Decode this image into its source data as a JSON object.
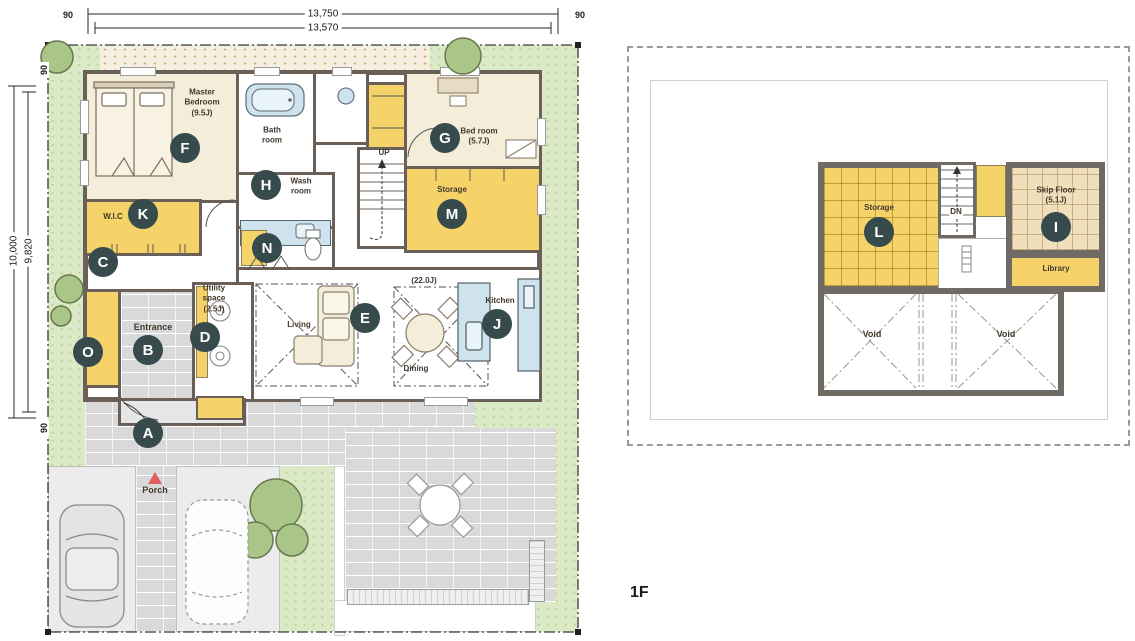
{
  "floor_label": "1F",
  "dimensions": {
    "top_outer": "13,750",
    "top_inner": "13,570",
    "side_outer": "10,000",
    "side_inner": "9,820",
    "edge_top_left": "90",
    "edge_top_right": "90",
    "edge_side_top": "90",
    "edge_side_bottom": "90"
  },
  "plan1f": {
    "master_bedroom": "Master\nBedroom\n(9.5J)",
    "wic": "W.I.C",
    "bath_room": "Bath\nroom",
    "wash_room": "Wash\nroom",
    "bed_room": "Bed room\n(5.7J)",
    "storage": "Storage",
    "stairs_up": "UP",
    "ldk_size": "(22.0J)",
    "living": "Living",
    "dining": "Dining",
    "kitchen": "Kitchen",
    "utility_space": "Utility\nspace\n(2.5J)",
    "entrance": "Entrance",
    "porch": "Porch"
  },
  "plan2f": {
    "storage": "Storage",
    "stairs_down": "DN",
    "skip_floor": "Skip Floor\n(5.1J)",
    "library": "Library",
    "void_left": "Void",
    "void_right": "Void"
  },
  "markers": {
    "a": "A",
    "b": "B",
    "c": "C",
    "d": "D",
    "e": "E",
    "f": "F",
    "g": "G",
    "h": "H",
    "i": "I",
    "j": "J",
    "k": "K",
    "l": "L",
    "m": "M",
    "n": "N",
    "o": "O"
  },
  "colors": {
    "wall": "#6a6058",
    "wall_2f": "#6f6a63",
    "room_yellow": "#f5d369",
    "room_cream": "#f3edda",
    "skip_floor_tan": "#efdfbc",
    "fixture_blue": "#cfe3ee",
    "grass_green": "#dbe9c6",
    "paving_gray": "#d9d9d9",
    "badge_dark": "#374a4c",
    "porch_arrow_red": "#e05f5f"
  }
}
